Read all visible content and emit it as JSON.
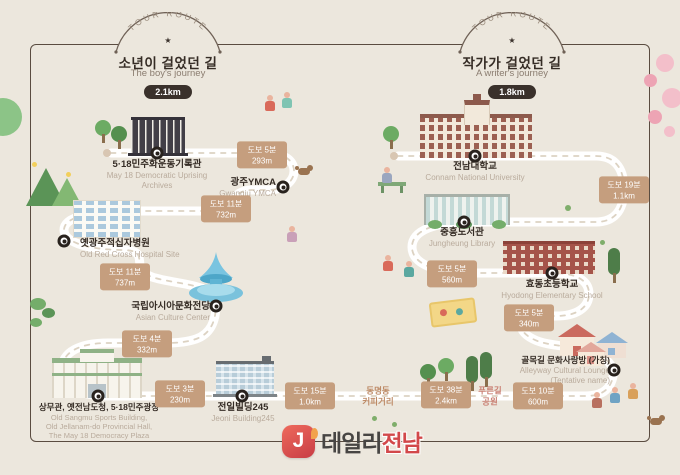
{
  "meta": {
    "background": "#ece7dd",
    "frame_color": "#5a4c40",
    "badge_color": "#c59e7e",
    "road_color": "#ffffff",
    "title_color": "#352c25",
    "accent_red": "#d2484a"
  },
  "headers": {
    "left": {
      "arc": "TOUR ROUTE",
      "star": "★",
      "title_ko": "소년이 걸었던 길",
      "title_en": "The boy's journey",
      "distance": "2.1km"
    },
    "right": {
      "arc": "TOUR ROUTE",
      "star": "★",
      "title_ko": "작가가 걸었던 길",
      "title_en": "A writer's journey",
      "distance": "1.8km"
    }
  },
  "stops": {
    "archives": {
      "ko": "5·18민주화운동기록관",
      "en": "May 18 Democratic Uprising\nArchives"
    },
    "ymca": {
      "ko": "광주YMCA",
      "en": "Gwangju YMCA"
    },
    "redcross": {
      "ko": "옛광주적십자병원",
      "en": "Old Red Cross Hospital Site"
    },
    "acc": {
      "ko": "국립아시아문화전당",
      "en": "Asian Culture Center"
    },
    "sangmu": {
      "ko": "상무관, 옛전남도청, 5·18민주광장",
      "en": "Old Sangmu Sports Building,\nOld Jellanam-do Provincial Hall,\nThe May 18 Democracy Plaza"
    },
    "jeonil": {
      "ko": "전일빌딩245",
      "en": "Jeoni Building245"
    },
    "cnu": {
      "ko": "전남대학교",
      "en": "Connam National University"
    },
    "library": {
      "ko": "중흥도서관",
      "en": "Jungheung Library"
    },
    "school": {
      "ko": "효동초등학교",
      "en": "Hyodong Elementary School"
    },
    "lounge": {
      "ko": "골목길 문화사랑방 (가칭)",
      "en": "Alleyway Cultural Lounge\n(Tentative name)"
    }
  },
  "waypoints": {
    "coffee": "동명동\n커피거리",
    "greenway": "푸른길\n공원"
  },
  "badges": {
    "b1": {
      "walk": "도보 5분",
      "dist": "293m"
    },
    "b2": {
      "walk": "도보 11분",
      "dist": "732m"
    },
    "b3": {
      "walk": "도보 11분",
      "dist": "737m"
    },
    "b4": {
      "walk": "도보 4분",
      "dist": "332m"
    },
    "b5": {
      "walk": "도보 3분",
      "dist": "230m"
    },
    "b6": {
      "walk": "도보 15분",
      "dist": "1.0km"
    },
    "b7": {
      "walk": "도보 38분",
      "dist": "2.4km"
    },
    "b8": {
      "walk": "도보 10분",
      "dist": "600m"
    },
    "b9": {
      "walk": "도보 19분",
      "dist": "1.1km"
    },
    "b10": {
      "walk": "도보 5분",
      "dist": "560m"
    },
    "b11": {
      "walk": "도보 5분",
      "dist": "340m"
    }
  },
  "logo": {
    "initial": "J",
    "name_dark": "데일리",
    "name_accent": "전남"
  }
}
